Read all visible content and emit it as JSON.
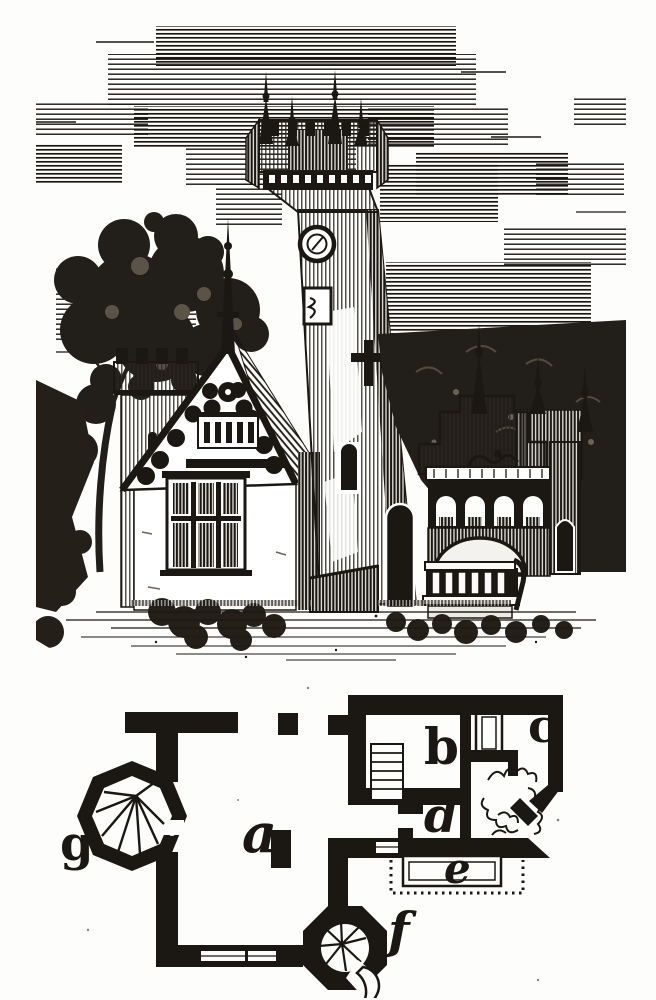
{
  "document": {
    "paper_color": "#fdfdfc",
    "ink_color": "#1b1713",
    "figures": [
      "engraved-perspective-view",
      "ground-floor-plan"
    ]
  },
  "plan": {
    "labels": [
      {
        "id": "a",
        "text": "a"
      },
      {
        "id": "b",
        "text": "b"
      },
      {
        "id": "c",
        "text": "c"
      },
      {
        "id": "d",
        "text": "d"
      },
      {
        "id": "e",
        "text": "e"
      },
      {
        "id": "f",
        "text": "f"
      },
      {
        "id": "g",
        "text": "g"
      }
    ]
  }
}
